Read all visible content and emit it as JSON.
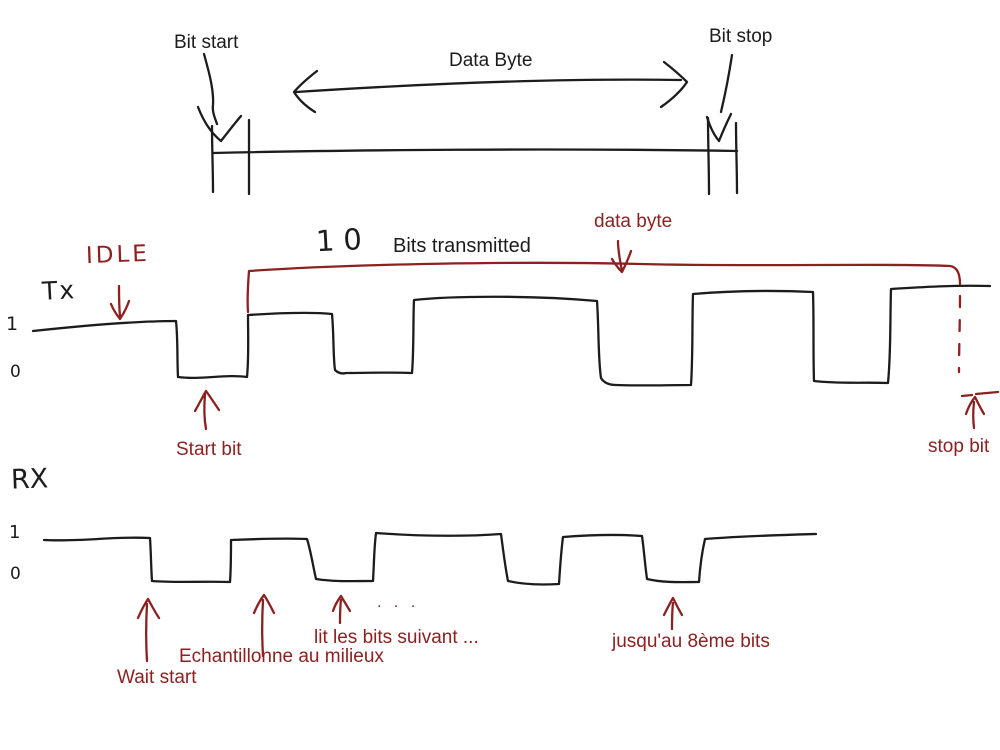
{
  "colors": {
    "ink": "#1c1c1c",
    "annotation_red": "#8b2121"
  },
  "top_diagram": {
    "bit_start": "Bit start",
    "data_byte": "Data Byte",
    "bit_stop": "Bit stop"
  },
  "tx": {
    "idle": "IDLE",
    "signal_name": "Tx",
    "level_high": "1",
    "level_low": "0",
    "bits_count": "10",
    "bits_transmitted": "Bits transmitted",
    "data_byte": "data byte",
    "start_bit": "Start bit",
    "stop_bit": "stop bit"
  },
  "rx": {
    "signal_name": "RX",
    "level_high": "1",
    "level_low": "0",
    "ellipsis": ". . .",
    "wait_start": "Wait start",
    "sample_middle": "Echantillonne au milieux",
    "read_next_bits": "lit les bits suivant ...",
    "until_8th_bit": "jusqu'au 8ème bits"
  }
}
